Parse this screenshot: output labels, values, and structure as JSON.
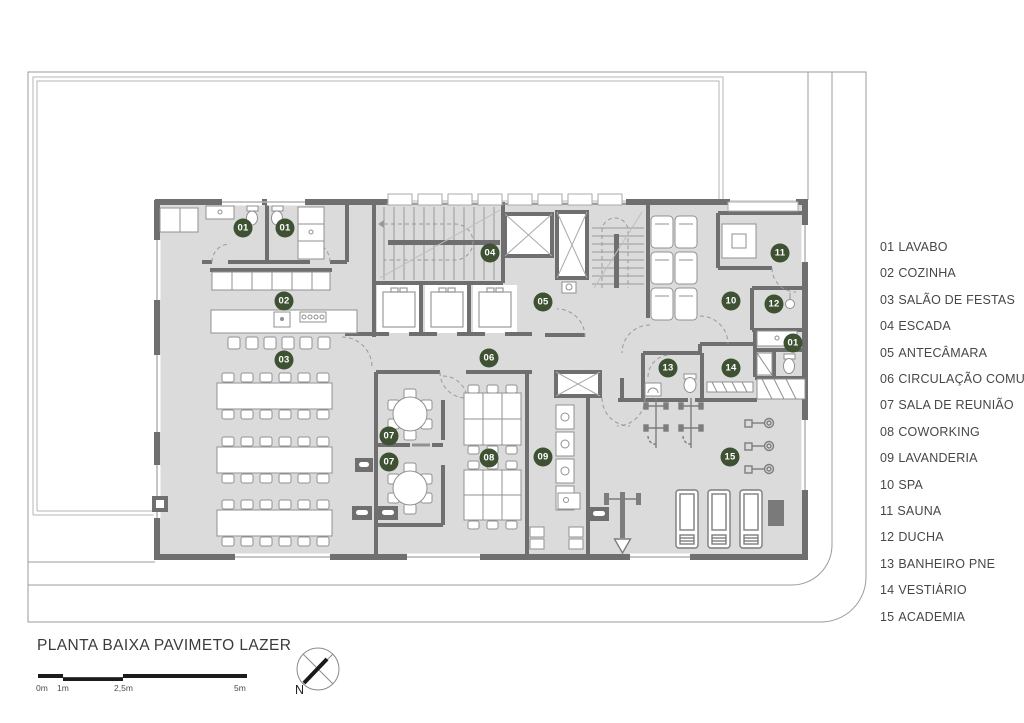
{
  "title_block": {
    "title": "PLANTA BAIXA PAVIMETO LAZER"
  },
  "scale_bar": {
    "labels": [
      "0m",
      "1m",
      "2,5m",
      "5m"
    ]
  },
  "compass": {
    "north_label": "N"
  },
  "legend": {
    "items": [
      {
        "number": "01",
        "label": "LAVABO"
      },
      {
        "number": "02",
        "label": "COZINHA"
      },
      {
        "number": "03",
        "label": "SALÃO DE FESTAS"
      },
      {
        "number": "04",
        "label": "ESCADA"
      },
      {
        "number": "05",
        "label": "ANTECÂMARA"
      },
      {
        "number": "06",
        "label": "CIRCULAÇÃO COMUM"
      },
      {
        "number": "07",
        "label": "SALA DE REUNIÃO"
      },
      {
        "number": "08",
        "label": "COWORKING"
      },
      {
        "number": "09",
        "label": "LAVANDERIA"
      },
      {
        "number": "10",
        "label": "SPA"
      },
      {
        "number": "11",
        "label": "SAUNA"
      },
      {
        "number": "12",
        "label": "DUCHA"
      },
      {
        "number": "13",
        "label": "BANHEIRO PNE"
      },
      {
        "number": "14",
        "label": "VESTIÁRIO"
      },
      {
        "number": "15",
        "label": "ACADEMIA"
      }
    ]
  },
  "plan": {
    "badges": [
      {
        "number": "01",
        "x": 243,
        "y": 228
      },
      {
        "number": "01",
        "x": 285,
        "y": 228
      },
      {
        "number": "02",
        "x": 284,
        "y": 301
      },
      {
        "number": "03",
        "x": 284,
        "y": 360
      },
      {
        "number": "04",
        "x": 490,
        "y": 253
      },
      {
        "number": "05",
        "x": 543,
        "y": 302
      },
      {
        "number": "06",
        "x": 489,
        "y": 358
      },
      {
        "number": "07",
        "x": 389,
        "y": 436
      },
      {
        "number": "07",
        "x": 389,
        "y": 462
      },
      {
        "number": "08",
        "x": 489,
        "y": 458
      },
      {
        "number": "09",
        "x": 543,
        "y": 457
      },
      {
        "number": "10",
        "x": 731,
        "y": 301
      },
      {
        "number": "11",
        "x": 780,
        "y": 253
      },
      {
        "number": "12",
        "x": 774,
        "y": 304
      },
      {
        "number": "01",
        "x": 793,
        "y": 343
      },
      {
        "number": "13",
        "x": 668,
        "y": 368
      },
      {
        "number": "14",
        "x": 731,
        "y": 368
      },
      {
        "number": "15",
        "x": 730,
        "y": 457
      }
    ]
  },
  "colors": {
    "badge_green": "#3e5233",
    "wall_gray": "#6f6f6f",
    "floor_gray": "#dbdbdb"
  }
}
